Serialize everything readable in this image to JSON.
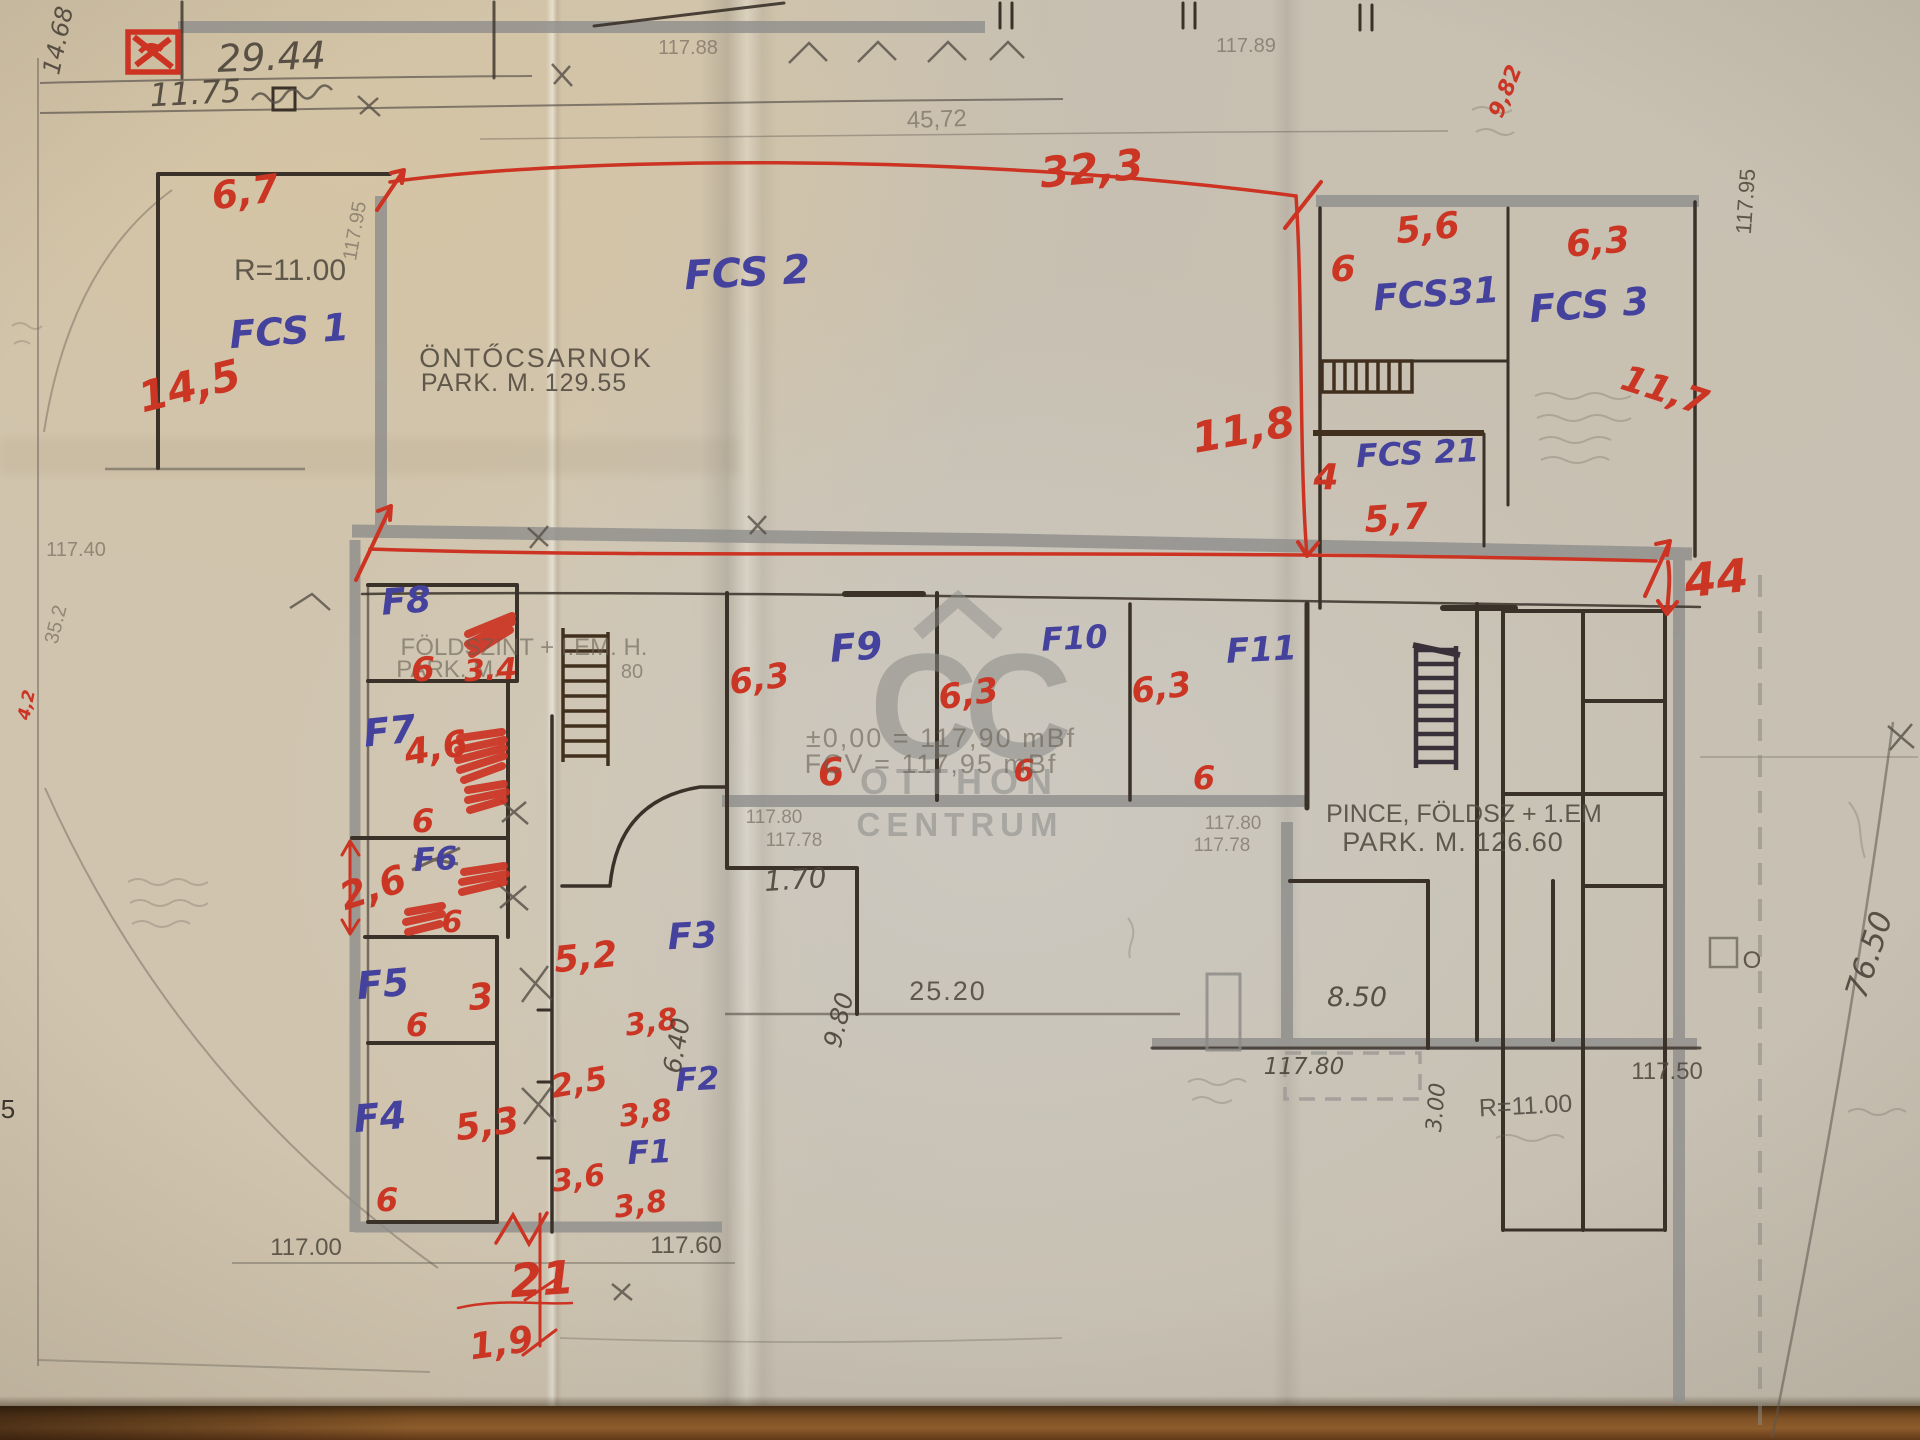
{
  "document": {
    "type": "scanned hand-annotated floor plan",
    "company_watermark": "Otthon Centrum"
  },
  "watermark": {
    "cc": "CC",
    "line1": "OTTHON",
    "line2": "CENTRUM"
  },
  "colors": {
    "red_ink": "#cb3524",
    "blue_ink": "#45429e",
    "pencil": "#51493f",
    "paper": "#d0c4ae",
    "wall_gray": "#908f8c"
  },
  "labels": [
    {
      "id": "dim-29-44",
      "t": "29.44",
      "x": 272,
      "y": 70,
      "s": 38,
      "c": "pencil-hand",
      "r": -2
    },
    {
      "id": "dim-11-75",
      "t": "11.75",
      "x": 196,
      "y": 104,
      "s": 32,
      "c": "pencil-hand",
      "r": -3
    },
    {
      "id": "dim-14-68",
      "t": "14.68",
      "x": 66,
      "y": 42,
      "s": 24,
      "c": "pencil-hand",
      "r": -78
    },
    {
      "id": "dim-117-88",
      "t": "117.88",
      "x": 688,
      "y": 54,
      "s": 20,
      "c": "faint"
    },
    {
      "id": "dim-117-89",
      "t": "117.89",
      "x": 1246,
      "y": 52,
      "s": 20,
      "c": "faint"
    },
    {
      "id": "dim-45-72",
      "t": "45,72",
      "x": 937,
      "y": 127,
      "s": 24,
      "c": "faint",
      "r": -2
    },
    {
      "id": "red-32-3",
      "t": "32,3",
      "x": 1093,
      "y": 183,
      "s": 42,
      "c": "red",
      "r": -5
    },
    {
      "id": "red-6-7",
      "t": "6,7",
      "x": 247,
      "y": 205,
      "s": 38,
      "c": "red",
      "r": -8
    },
    {
      "id": "red-14-5",
      "t": "14,5",
      "x": 193,
      "y": 400,
      "s": 42,
      "c": "red",
      "r": -14
    },
    {
      "id": "r11-left",
      "t": "R=11.00",
      "x": 290,
      "y": 280,
      "s": 30,
      "c": "pencil"
    },
    {
      "id": "dim-117-95-left",
      "t": "117.95",
      "x": 361,
      "y": 232,
      "s": 20,
      "c": "faint",
      "r": -80
    },
    {
      "id": "room-fcs1",
      "t": "FCS 1",
      "x": 290,
      "y": 344,
      "s": 38,
      "c": "blue",
      "r": -4
    },
    {
      "id": "room-fcs2",
      "t": "FCS 2",
      "x": 748,
      "y": 286,
      "s": 40,
      "c": "blue",
      "r": -3
    },
    {
      "id": "text-ontocsarnok",
      "t": "ÖNTŐCSARNOK",
      "x": 536,
      "y": 367,
      "s": 27,
      "c": "pencil",
      "ls": 2
    },
    {
      "id": "text-park-129-55",
      "t": "PARK. M. 129.55",
      "x": 524,
      "y": 391,
      "s": 25,
      "c": "pencil",
      "ls": 1
    },
    {
      "id": "red-5-6",
      "t": "5,6",
      "x": 1429,
      "y": 240,
      "s": 36,
      "c": "red",
      "r": -6
    },
    {
      "id": "red-6-fcs31",
      "t": "6",
      "x": 1343,
      "y": 281,
      "s": 36,
      "c": "red"
    },
    {
      "id": "room-fcs31",
      "t": "FCS31",
      "x": 1437,
      "y": 306,
      "s": 36,
      "c": "blue",
      "r": -4
    },
    {
      "id": "red-6-3-fcs3",
      "t": "6,3",
      "x": 1599,
      "y": 254,
      "s": 36,
      "c": "red",
      "r": -5
    },
    {
      "id": "room-fcs3",
      "t": "FCS 3",
      "x": 1590,
      "y": 318,
      "s": 38,
      "c": "blue",
      "r": -4
    },
    {
      "id": "red-11-7",
      "t": "11,7",
      "x": 1661,
      "y": 402,
      "s": 36,
      "c": "red",
      "r": 18
    },
    {
      "id": "red-11-8",
      "t": "11,8",
      "x": 1246,
      "y": 444,
      "s": 42,
      "c": "red",
      "r": -10
    },
    {
      "id": "red-4",
      "t": "4",
      "x": 1326,
      "y": 489,
      "s": 36,
      "c": "red"
    },
    {
      "id": "room-fcs21",
      "t": "FCS 21",
      "x": 1418,
      "y": 464,
      "s": 32,
      "c": "blue",
      "r": -3
    },
    {
      "id": "red-5-7",
      "t": "5,7",
      "x": 1397,
      "y": 530,
      "s": 36,
      "c": "red",
      "r": -4
    },
    {
      "id": "red-44",
      "t": "44",
      "x": 1718,
      "y": 594,
      "s": 46,
      "c": "red",
      "r": -6
    },
    {
      "id": "red-9-82",
      "t": "9,82",
      "x": 1512,
      "y": 94,
      "s": 22,
      "c": "red",
      "r": -68
    },
    {
      "id": "room-f8",
      "t": "F8",
      "x": 407,
      "y": 613,
      "s": 36,
      "c": "blue",
      "r": -4
    },
    {
      "id": "text-foldszint",
      "t": "FÖLDSZINT + I.EM. H.",
      "x": 524,
      "y": 655,
      "s": 24,
      "c": "faint"
    },
    {
      "id": "text-park-f8",
      "t": "PARK. M.",
      "x": 448,
      "y": 677,
      "s": 24,
      "c": "faint"
    },
    {
      "id": "text-80",
      "t": "80",
      "x": 632,
      "y": 678,
      "s": 20,
      "c": "faint"
    },
    {
      "id": "red-6-f8",
      "t": "6",
      "x": 423,
      "y": 681,
      "s": 34,
      "c": "red"
    },
    {
      "id": "red-3-4",
      "t": "3.4",
      "x": 491,
      "y": 680,
      "s": 30,
      "c": "red",
      "r": -3
    },
    {
      "id": "room-f7",
      "t": "F7",
      "x": 391,
      "y": 744,
      "s": 38,
      "c": "blue",
      "r": -6
    },
    {
      "id": "red-4-6",
      "t": "4,6",
      "x": 438,
      "y": 760,
      "s": 36,
      "c": "red",
      "r": -10
    },
    {
      "id": "red-6-f7",
      "t": "6",
      "x": 423,
      "y": 832,
      "s": 32,
      "c": "red"
    },
    {
      "id": "room-f6",
      "t": "F6",
      "x": 436,
      "y": 870,
      "s": 32,
      "c": "blue",
      "r": -3
    },
    {
      "id": "red-2-6",
      "t": "2,6",
      "x": 377,
      "y": 900,
      "s": 38,
      "c": "red",
      "r": -18
    },
    {
      "id": "red-6-f6",
      "t": "6",
      "x": 452,
      "y": 932,
      "s": 30,
      "c": "red"
    },
    {
      "id": "room-f5",
      "t": "F5",
      "x": 384,
      "y": 997,
      "s": 38,
      "c": "blue",
      "r": -5
    },
    {
      "id": "red-3",
      "t": "3",
      "x": 482,
      "y": 1009,
      "s": 36,
      "c": "red",
      "r": -6
    },
    {
      "id": "red-6-f5",
      "t": "6",
      "x": 417,
      "y": 1036,
      "s": 32,
      "c": "red"
    },
    {
      "id": "red-5-2",
      "t": "5,2",
      "x": 587,
      "y": 969,
      "s": 36,
      "c": "red",
      "r": -6
    },
    {
      "id": "room-f3",
      "t": "F3",
      "x": 693,
      "y": 948,
      "s": 36,
      "c": "blue",
      "r": -3
    },
    {
      "id": "red-3-8-f3",
      "t": "3,8",
      "x": 653,
      "y": 1032,
      "s": 30,
      "c": "red",
      "r": -8
    },
    {
      "id": "red-2-5",
      "t": "2,5",
      "x": 581,
      "y": 1093,
      "s": 32,
      "c": "red",
      "r": -10
    },
    {
      "id": "room-f2",
      "t": "F2",
      "x": 698,
      "y": 1090,
      "s": 32,
      "c": "blue",
      "r": -3
    },
    {
      "id": "red-3-8-f2",
      "t": "3,8",
      "x": 647,
      "y": 1123,
      "s": 30,
      "c": "red",
      "r": -8
    },
    {
      "id": "red-5-3",
      "t": "5,3",
      "x": 489,
      "y": 1136,
      "s": 36,
      "c": "red",
      "r": -8
    },
    {
      "id": "room-f4",
      "t": "F4",
      "x": 381,
      "y": 1130,
      "s": 38,
      "c": "blue",
      "r": -5
    },
    {
      "id": "red-3-6",
      "t": "3,6",
      "x": 580,
      "y": 1188,
      "s": 30,
      "c": "red",
      "r": -8
    },
    {
      "id": "room-f1",
      "t": "F1",
      "x": 650,
      "y": 1163,
      "s": 32,
      "c": "blue",
      "r": -3
    },
    {
      "id": "red-3-8-f1",
      "t": "3,8",
      "x": 642,
      "y": 1214,
      "s": 30,
      "c": "red",
      "r": -8
    },
    {
      "id": "red-6-f4",
      "t": "6",
      "x": 387,
      "y": 1211,
      "s": 32,
      "c": "red"
    },
    {
      "id": "red-21",
      "t": "21",
      "x": 543,
      "y": 1295,
      "s": 46,
      "c": "red",
      "r": -4
    },
    {
      "id": "red-1-9",
      "t": "1,9",
      "x": 503,
      "y": 1355,
      "s": 36,
      "c": "red",
      "r": -8
    },
    {
      "id": "room-f9",
      "t": "F9",
      "x": 857,
      "y": 660,
      "s": 38,
      "c": "blue",
      "r": -4
    },
    {
      "id": "red-6-3-f9",
      "t": "6,3",
      "x": 761,
      "y": 690,
      "s": 34,
      "c": "red",
      "r": -8
    },
    {
      "id": "red-6-center",
      "t": "6",
      "x": 832,
      "y": 785,
      "s": 38,
      "c": "red",
      "r": -5
    },
    {
      "id": "room-f10",
      "t": "F10",
      "x": 1075,
      "y": 649,
      "s": 32,
      "c": "blue",
      "r": -3
    },
    {
      "id": "red-6-3-f10",
      "t": "6,3",
      "x": 970,
      "y": 705,
      "s": 34,
      "c": "red",
      "r": -8
    },
    {
      "id": "red-6-f10",
      "t": "6",
      "x": 1024,
      "y": 781,
      "s": 30,
      "c": "red"
    },
    {
      "id": "room-f11",
      "t": "F11",
      "x": 1262,
      "y": 661,
      "s": 34,
      "c": "blue",
      "r": -3
    },
    {
      "id": "red-6-3-f11",
      "t": "6,3",
      "x": 1163,
      "y": 699,
      "s": 34,
      "c": "red",
      "r": -8
    },
    {
      "id": "red-6-f11",
      "t": "6",
      "x": 1204,
      "y": 789,
      "s": 32,
      "c": "red"
    },
    {
      "id": "text-pm000",
      "t": "±0,00 = 117,90 mBf",
      "x": 941,
      "y": 747,
      "s": 27,
      "c": "faint",
      "ls": 2
    },
    {
      "id": "text-fcv",
      "t": "FCV = 117,95 mBf",
      "x": 931,
      "y": 773,
      "s": 27,
      "c": "faint",
      "ls": 2
    },
    {
      "id": "text-pince",
      "t": "PINCE, FÖLDSZ + 1.EM",
      "x": 1464,
      "y": 822,
      "s": 25,
      "c": "pencil"
    },
    {
      "id": "text-park-126-60",
      "t": "PARK. M. 126.60",
      "x": 1453,
      "y": 851,
      "s": 27,
      "c": "pencil",
      "ls": 1
    },
    {
      "id": "dim-117-80-c",
      "t": "117.80",
      "x": 774,
      "y": 823,
      "s": 19,
      "c": "faint"
    },
    {
      "id": "dim-117-78-c",
      "t": "117.78",
      "x": 794,
      "y": 846,
      "s": 19,
      "c": "faint"
    },
    {
      "id": "dim-1-70",
      "t": "1.70",
      "x": 796,
      "y": 889,
      "s": 28,
      "c": "pencil-hand",
      "r": -4
    },
    {
      "id": "dim-117-80-r",
      "t": "117.80",
      "x": 1233,
      "y": 829,
      "s": 19,
      "c": "faint"
    },
    {
      "id": "dim-117-78-r",
      "t": "117.78",
      "x": 1222,
      "y": 851,
      "s": 19,
      "c": "faint"
    },
    {
      "id": "dim-9-80",
      "t": "9.80",
      "x": 847,
      "y": 1022,
      "s": 25,
      "c": "pencil-hand",
      "r": -76
    },
    {
      "id": "dim-6-40",
      "t": "6.40",
      "x": 685,
      "y": 1047,
      "s": 25,
      "c": "pencil-hand",
      "r": -80
    },
    {
      "id": "dim-25-20",
      "t": "25.20",
      "x": 948,
      "y": 1000,
      "s": 27,
      "c": "pencil",
      "ls": 2
    },
    {
      "id": "dim-8-50",
      "t": "8.50",
      "x": 1357,
      "y": 1006,
      "s": 27,
      "c": "pencil-hand"
    },
    {
      "id": "dim-117-80-hand",
      "t": "117.80",
      "x": 1304,
      "y": 1074,
      "s": 23,
      "c": "pencil-hand"
    },
    {
      "id": "dim-3-00",
      "t": "3.00",
      "x": 1443,
      "y": 1108,
      "s": 22,
      "c": "pencil-hand",
      "r": -85
    },
    {
      "id": "r11-right",
      "t": "R=11.00",
      "x": 1526,
      "y": 1114,
      "s": 25,
      "c": "pencil",
      "r": -3
    },
    {
      "id": "dim-117-50",
      "t": "117.50",
      "x": 1667,
      "y": 1079,
      "s": 24,
      "c": "pencil"
    },
    {
      "id": "dim-76-50",
      "t": "76.50",
      "x": 1879,
      "y": 958,
      "s": 31,
      "c": "pencil-hand",
      "r": -72
    },
    {
      "id": "dim-117-00",
      "t": "117.00",
      "x": 306,
      "y": 1255,
      "s": 24,
      "c": "pencil"
    },
    {
      "id": "dim-117-60",
      "t": "117.60",
      "x": 686,
      "y": 1253,
      "s": 24,
      "c": "pencil"
    },
    {
      "id": "dim-117-40",
      "t": "117.40",
      "x": 76,
      "y": 556,
      "s": 20,
      "c": "faint"
    },
    {
      "id": "dim-35-2",
      "t": "35.2",
      "x": 62,
      "y": 626,
      "s": 20,
      "c": "faint",
      "r": -76
    },
    {
      "id": "dim-117-95-right",
      "t": "117.95",
      "x": 1753,
      "y": 202,
      "s": 22,
      "c": "pencil",
      "r": -86
    },
    {
      "id": "num-5-edge",
      "t": "5",
      "x": 8,
      "y": 1118,
      "s": 26,
      "c": "pencil-dark"
    },
    {
      "id": "red-4-2-edge",
      "t": "4,2",
      "x": 32,
      "y": 706,
      "s": 17,
      "c": "red",
      "r": -78
    },
    {
      "id": "letter-o",
      "t": "O",
      "x": 1752,
      "y": 968,
      "s": 24,
      "c": "pencil"
    }
  ]
}
